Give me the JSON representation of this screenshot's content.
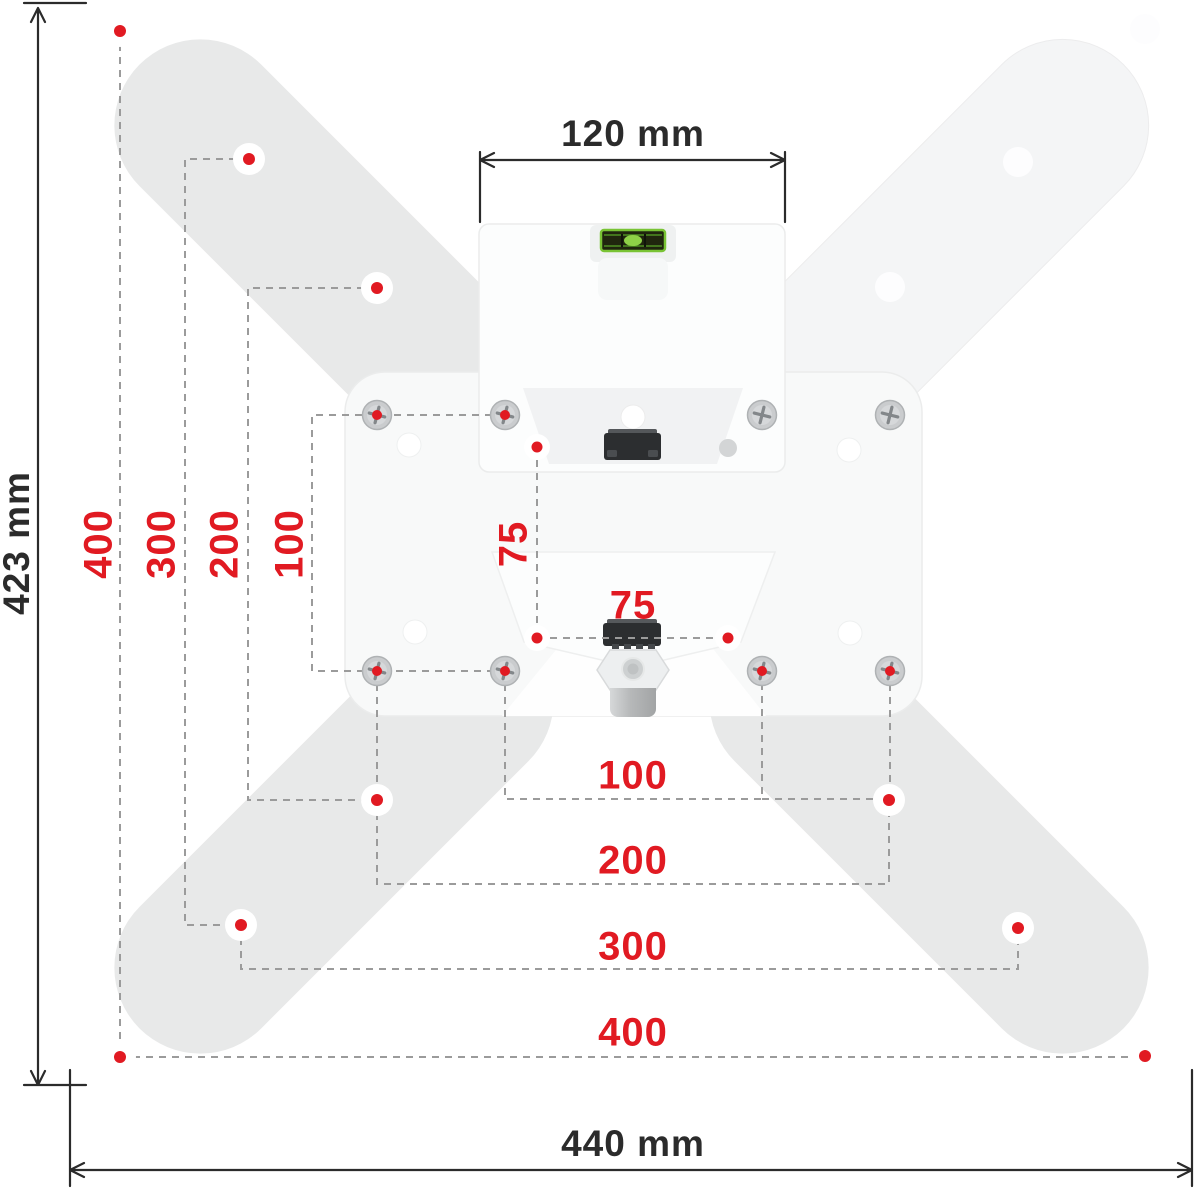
{
  "labels": {
    "dim_top": "120 mm",
    "dim_left": "423 mm",
    "dim_bottom": "440 mm",
    "vesa_left": [
      "400",
      "300",
      "200",
      "100",
      "75"
    ],
    "vesa_bottom": [
      "75",
      "100",
      "200",
      "300",
      "400"
    ]
  },
  "colors": {
    "accent_red": "#e11a22",
    "dash_gray": "#9b9b9b",
    "line_black": "#2b2b2b",
    "arm_gray": "#e8e9e9",
    "arm_light": "#f4f5f6",
    "plate_white": "#f8f9f9",
    "bracket_white": "#fcfdfd",
    "level_green": "#79c334"
  }
}
